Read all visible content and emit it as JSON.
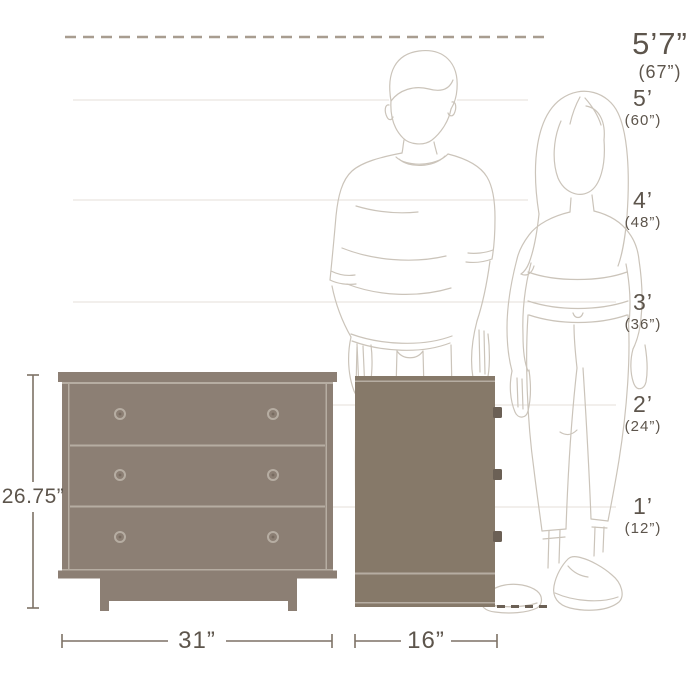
{
  "height_markers": [
    {
      "label": "5’7”",
      "sub": "(67”)"
    },
    {
      "label": "5’",
      "sub": "(60”)"
    },
    {
      "label": "4’",
      "sub": "(48”)"
    },
    {
      "label": "3’",
      "sub": "(36”)"
    },
    {
      "label": "2’",
      "sub": "(24”)"
    },
    {
      "label": "1’",
      "sub": "(12”)"
    }
  ],
  "dimensions": {
    "height": "26.75”",
    "width": "31”",
    "depth": "16”"
  },
  "colors": {
    "furniture": "#8c7f74",
    "furniture_dark": "#867969",
    "divider_light": "#b6ada2",
    "text": "#5d554c",
    "dimension": "#7d7166",
    "outline": "#cbc4ba",
    "gridline": "#e4dfd8",
    "dashed_line": "#a89d90",
    "knob_dark": "#6b6055"
  }
}
